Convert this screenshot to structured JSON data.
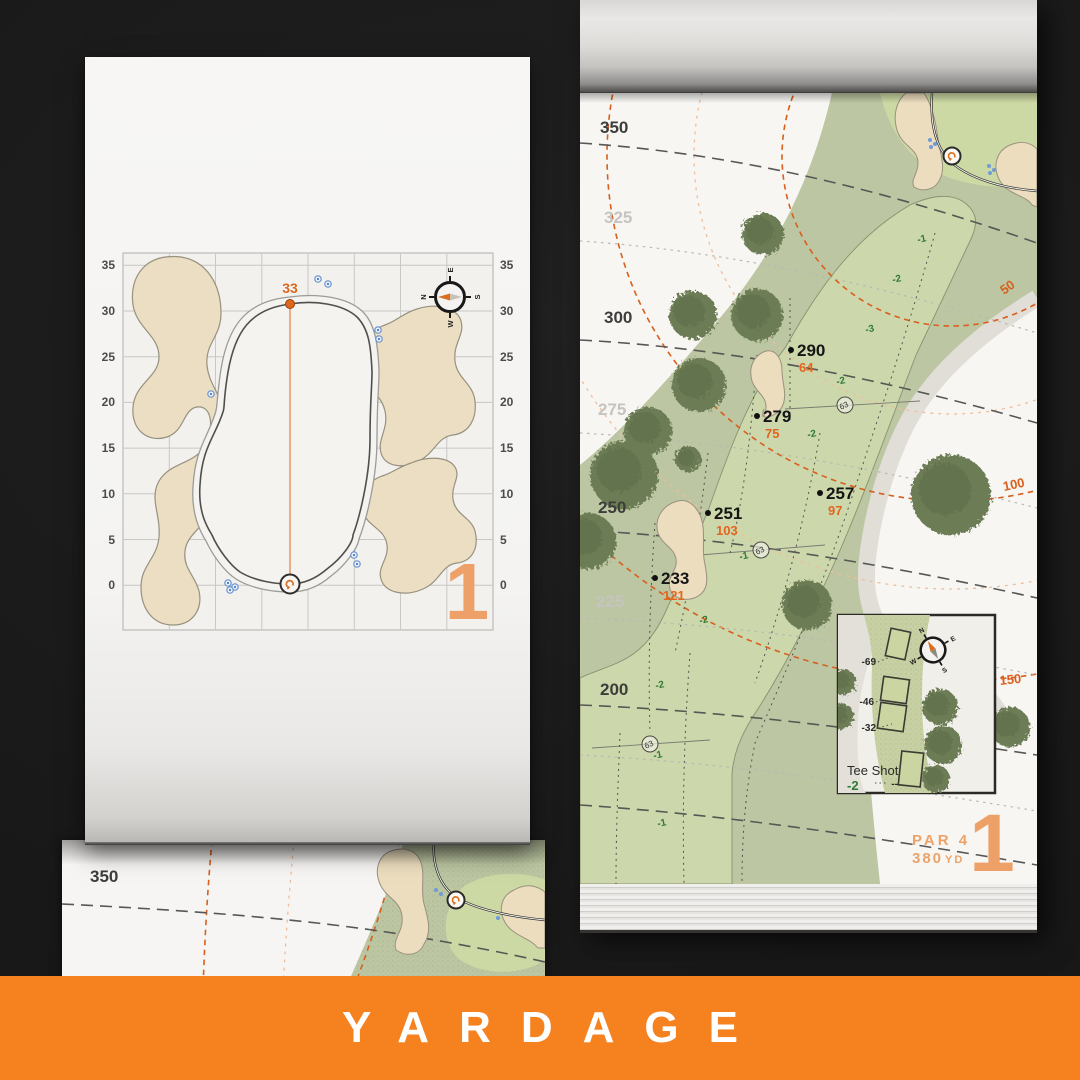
{
  "banner": {
    "title": "YARDAGE",
    "color": "#f5821f"
  },
  "compass": {
    "n": "N",
    "e": "E",
    "s": "S",
    "w": "W"
  },
  "green_page": {
    "pin_depth": "33",
    "hole_number": "1",
    "axis": [
      "35",
      "30",
      "25",
      "20",
      "15",
      "10",
      "5",
      "0"
    ]
  },
  "hole_page": {
    "hole_number": "1",
    "par_label": "PAR 4",
    "yardage_value": "380",
    "yardage_unit": "YD",
    "distance_labels": [
      "350",
      "325",
      "300",
      "275",
      "250",
      "225",
      "200"
    ],
    "arc_labels": [
      "50",
      "100",
      "150"
    ],
    "markers": [
      {
        "main": "290",
        "sub": "64"
      },
      {
        "main": "279",
        "sub": "75"
      },
      {
        "main": "257",
        "sub": "97"
      },
      {
        "main": "251",
        "sub": "103"
      },
      {
        "main": "233",
        "sub": "121"
      }
    ],
    "sprinklers": [
      "63",
      "63",
      "63"
    ],
    "slopes": [
      "-1",
      "-2",
      "-3",
      "-2",
      "-2",
      "-1",
      "-2",
      "-2",
      "-1",
      "-1"
    ],
    "tee_inset": {
      "title": "Tee Shot",
      "slope": "-2",
      "tees": [
        "-69",
        "-46",
        "-32"
      ],
      "back_tee": "--"
    }
  },
  "under_page": {
    "labels": [
      "350",
      "325"
    ]
  }
}
